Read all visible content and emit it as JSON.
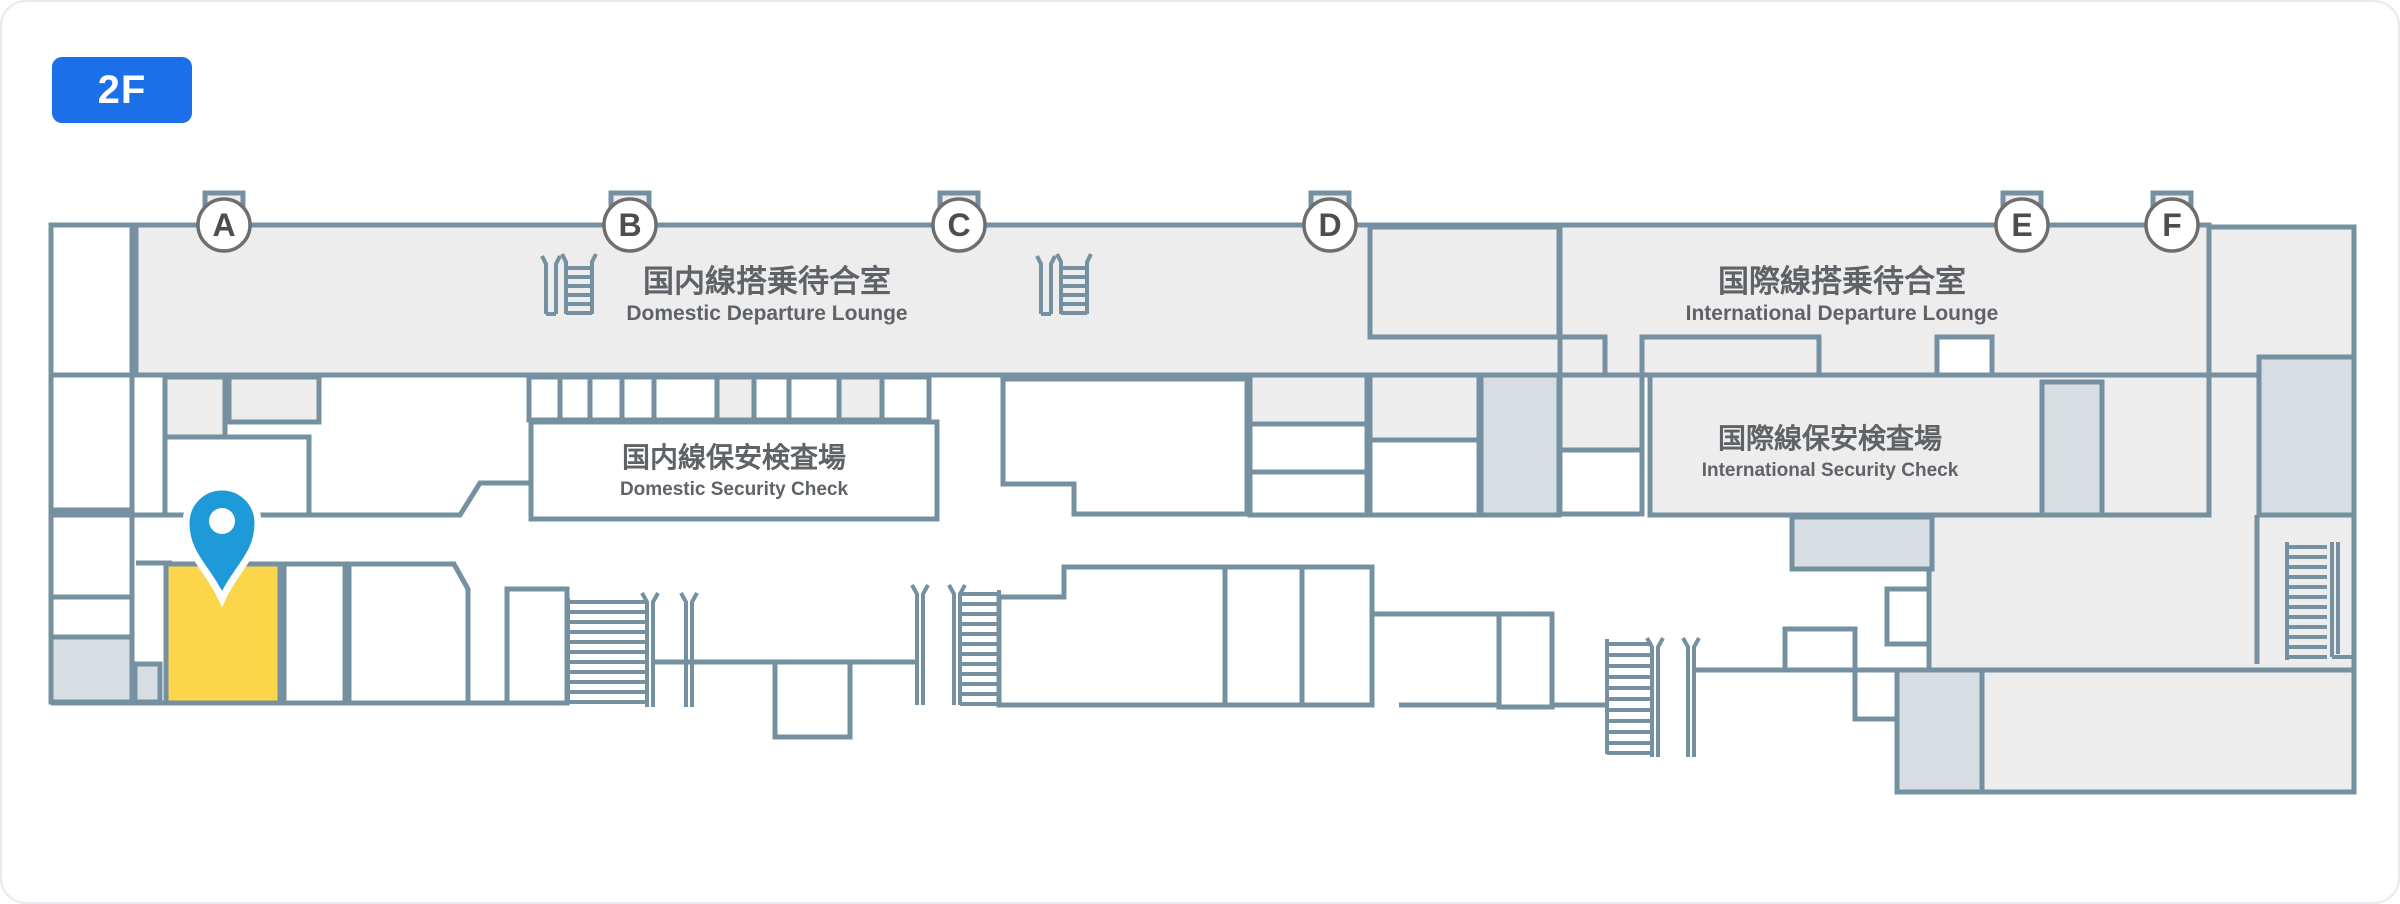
{
  "floor_badge": {
    "label": "2F",
    "color": "#1B6FE8"
  },
  "gates": [
    {
      "label": "A"
    },
    {
      "label": "B"
    },
    {
      "label": "C"
    },
    {
      "label": "D"
    },
    {
      "label": "E"
    },
    {
      "label": "F"
    }
  ],
  "areas": {
    "domestic_lounge": {
      "title_jp": "国内線搭乗待合室",
      "title_en": "Domestic Departure Lounge"
    },
    "domestic_security": {
      "title_jp": "国内線保安検査場",
      "title_en": "Domestic Security Check"
    },
    "international_lounge": {
      "title_jp": "国際線搭乗待合室",
      "title_en": "International Departure Lounge"
    },
    "international_security": {
      "title_jp": "国際線保安検査場",
      "title_en": "International Security Check"
    }
  },
  "colors": {
    "wall": "#7590A0",
    "floor_light": "#EDEDEE",
    "floor_shaded": "#D6DEE3",
    "highlight_room": "#FBD54A",
    "location_pin": "#1D9AD7",
    "badge": "#1B6FE8"
  }
}
